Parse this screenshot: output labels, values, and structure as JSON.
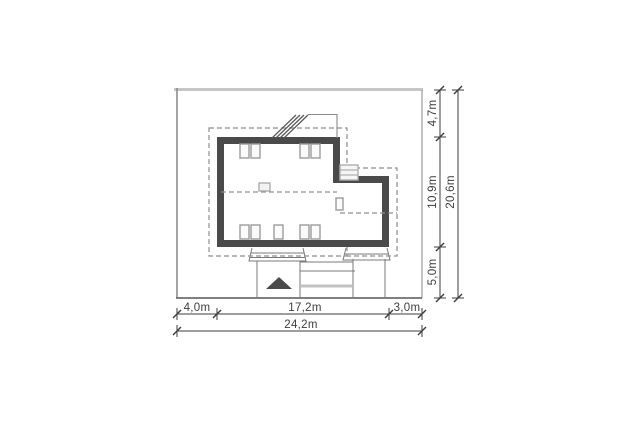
{
  "drawing": {
    "kind": "architectural-site-plan",
    "dimensions": {
      "bottom": {
        "segments": [
          "4,0m",
          "17,2m",
          "3,0m"
        ],
        "total": "24,2m"
      },
      "right": {
        "segments": [
          "4,7m",
          "10,9m",
          "5,0m"
        ],
        "total": "20,6m"
      }
    },
    "colors": {
      "wall": "#4a4a4a",
      "dashed": "#8f8f8f",
      "dimension": "#3d3d3d",
      "marker": "#4a4a4a",
      "plot_border_top": "#c6c6c6",
      "plot_border_side": "#858585",
      "paving_light": "#c2c2c2",
      "background": "#ffffff"
    },
    "icons": {
      "entrance_arrow": "triangle-up"
    }
  }
}
